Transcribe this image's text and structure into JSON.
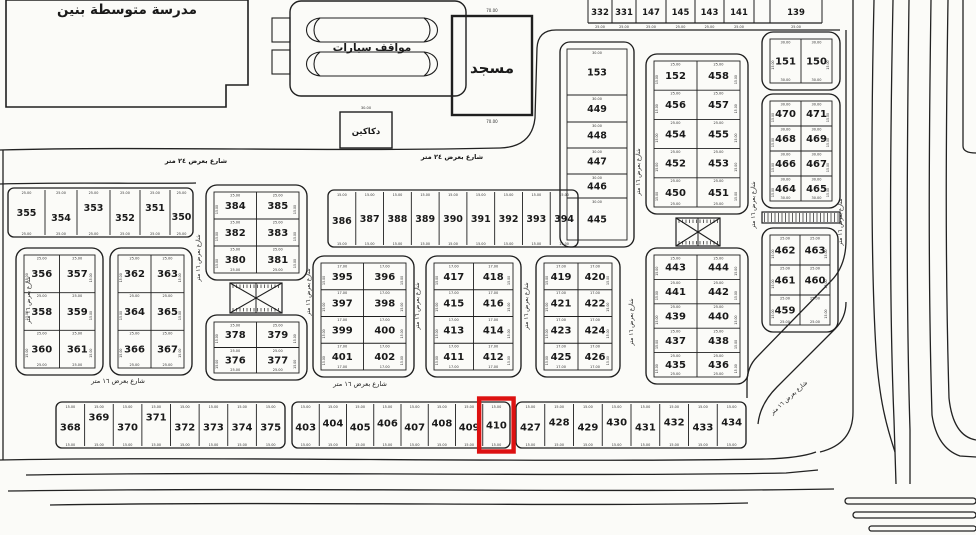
{
  "canvas": {
    "width": 976,
    "height": 535,
    "background": "#fbfbf8",
    "ink": "#1f1f1f",
    "highlight_color": "#dd1111"
  },
  "landmarks": {
    "school": {
      "label": "مدرسة متوسطة بنين"
    },
    "parking": {
      "label": "مواقف سيارات"
    },
    "mosque": {
      "label": "مسجد",
      "dim_top": "70.00",
      "dim_bottom": "70.00"
    },
    "shops": {
      "label": "دكاكين",
      "dim_top": "30.00"
    }
  },
  "streets": {
    "label_16": "شارع بعرض ١٦ متر",
    "label_24": "شارع بعرض ٢٤ متر",
    "placements": [
      {
        "x": 196,
        "y": 163,
        "r": 0,
        "t": "24"
      },
      {
        "x": 452,
        "y": 159,
        "r": 0,
        "t": "24"
      },
      {
        "x": 118,
        "y": 383,
        "r": 0,
        "t": "16"
      },
      {
        "x": 360,
        "y": 386,
        "r": 0,
        "t": "16"
      },
      {
        "x": 790,
        "y": 399,
        "r": -42,
        "t": "16"
      },
      {
        "x": 30,
        "y": 300,
        "r": -90,
        "t": "16"
      },
      {
        "x": 200,
        "y": 258,
        "r": -90,
        "t": "16"
      },
      {
        "x": 310,
        "y": 292,
        "r": -90,
        "t": "16"
      },
      {
        "x": 419,
        "y": 306,
        "r": -90,
        "t": "16"
      },
      {
        "x": 528,
        "y": 306,
        "r": -90,
        "t": "16"
      },
      {
        "x": 640,
        "y": 172,
        "r": -90,
        "t": "16"
      },
      {
        "x": 633,
        "y": 322,
        "r": -90,
        "t": "16"
      },
      {
        "x": 755,
        "y": 205,
        "r": -90,
        "t": "16"
      },
      {
        "x": 842,
        "y": 222,
        "r": -90,
        "t": "16"
      }
    ]
  },
  "dims": {
    "cell": "25.00",
    "strip": "15.00",
    "narrow": "17.00",
    "column": "30.00",
    "side": "15.00"
  },
  "highlight": {
    "plot": "410"
  },
  "top_row": {
    "x": 588,
    "y": 0,
    "h": 23,
    "fs": 8.5,
    "dim": "25.00",
    "cells": [
      "332",
      "331",
      "147",
      "145",
      "143",
      "141",
      "",
      "139"
    ],
    "widths": [
      24,
      24,
      30,
      29,
      29,
      30,
      16,
      52
    ]
  },
  "stack": {
    "x": 560,
    "y": 42,
    "w": 74,
    "h": 205,
    "dim": "30.00",
    "cells": [
      {
        "n": "153",
        "h": 46
      },
      {
        "n": "449",
        "h": 27
      },
      {
        "n": "448",
        "h": 26
      },
      {
        "n": "447",
        "h": 26
      },
      {
        "n": "446",
        "h": 24
      },
      {
        "n": "445",
        "h": 42
      }
    ]
  },
  "blocks": [
    {
      "id": "151-150",
      "x": 762,
      "y": 32,
      "w": 78,
      "h": 58,
      "dim": "30.00",
      "rows": [
        [
          "151",
          "150"
        ]
      ]
    },
    {
      "id": "464-471",
      "x": 762,
      "y": 94,
      "w": 78,
      "h": 114,
      "dim": "30.00",
      "rows": [
        [
          "470",
          "471"
        ],
        [
          "468",
          "469"
        ],
        [
          "466",
          "467"
        ],
        [
          "464",
          "465"
        ]
      ]
    },
    {
      "id": "459-463",
      "x": 762,
      "y": 228,
      "w": 76,
      "h": 104,
      "dim": "25.00",
      "rows": [
        [
          "462",
          "463"
        ],
        [
          "461",
          "460"
        ],
        [
          "459",
          ""
        ]
      ]
    },
    {
      "id": "450-458",
      "x": 646,
      "y": 54,
      "w": 102,
      "h": 160,
      "dim": "25.00",
      "rows": [
        [
          "152",
          "458"
        ],
        [
          "456",
          "457"
        ],
        [
          "454",
          "455"
        ],
        [
          "452",
          "453"
        ],
        [
          "450",
          "451"
        ]
      ]
    },
    {
      "id": "435-444",
      "x": 646,
      "y": 248,
      "w": 102,
      "h": 136,
      "dim": "25.00",
      "rows": [
        [
          "443",
          "444"
        ],
        [
          "441",
          "442"
        ],
        [
          "439",
          "440"
        ],
        [
          "437",
          "438"
        ],
        [
          "435",
          "436"
        ]
      ]
    },
    {
      "id": "380-385",
      "x": 206,
      "y": 185,
      "w": 101,
      "h": 95,
      "dim": "25.00",
      "rows": [
        [
          "384",
          "385"
        ],
        [
          "382",
          "383"
        ],
        [
          "380",
          "381"
        ]
      ]
    },
    {
      "id": "376-379",
      "x": 206,
      "y": 315,
      "w": 101,
      "h": 65,
      "dim": "25.00",
      "rows": [
        [
          "378",
          "379"
        ],
        [
          "376",
          "377"
        ]
      ]
    },
    {
      "id": "356-361",
      "x": 16,
      "y": 248,
      "w": 87,
      "h": 127,
      "dim": "25.00",
      "rows": [
        [
          "356",
          "357"
        ],
        [
          "358",
          "359"
        ],
        [
          "360",
          "361"
        ]
      ]
    },
    {
      "id": "362-367",
      "x": 110,
      "y": 248,
      "w": 82,
      "h": 127,
      "dim": "25.00",
      "rows": [
        [
          "362",
          "363"
        ],
        [
          "364",
          "365"
        ],
        [
          "366",
          "367"
        ]
      ]
    },
    {
      "id": "395-402",
      "x": 313,
      "y": 256,
      "w": 101,
      "h": 121,
      "dim": "17.00",
      "rows": [
        [
          "395",
          "396"
        ],
        [
          "397",
          "398"
        ],
        [
          "399",
          "400"
        ],
        [
          "401",
          "402"
        ]
      ]
    },
    {
      "id": "411-418",
      "x": 426,
      "y": 256,
      "w": 95,
      "h": 121,
      "dim": "17.00",
      "rows": [
        [
          "417",
          "418"
        ],
        [
          "415",
          "416"
        ],
        [
          "413",
          "414"
        ],
        [
          "411",
          "412"
        ]
      ]
    },
    {
      "id": "419-426",
      "x": 536,
      "y": 256,
      "w": 84,
      "h": 121,
      "dim": "17.00",
      "rows": [
        [
          "419",
          "420"
        ],
        [
          "421",
          "422"
        ],
        [
          "423",
          "424"
        ],
        [
          "425",
          "426"
        ]
      ]
    }
  ],
  "strips": [
    {
      "id": "row-350-355",
      "x": 8,
      "y": 188,
      "w": 185,
      "h": 49,
      "fs": 9.5,
      "dim": "25.00",
      "cells": [
        "355",
        "354",
        "353",
        "352",
        "351",
        "350"
      ],
      "widths": [
        37,
        32,
        33,
        30,
        30,
        23
      ],
      "offsets": [
        0,
        5,
        -5,
        5,
        -5,
        4
      ]
    },
    {
      "id": "row-386-394",
      "x": 328,
      "y": 190,
      "w": 250,
      "h": 57,
      "fs": 9.5,
      "dim": "15.00",
      "cells": [
        "386",
        "387",
        "388",
        "389",
        "390",
        "391",
        "392",
        "393",
        "394"
      ],
      "offsets": [
        2,
        0,
        0,
        0,
        0,
        0,
        0,
        0,
        0
      ]
    },
    {
      "id": "row-368-375",
      "x": 56,
      "y": 402,
      "w": 229,
      "h": 46,
      "fs": 10,
      "dim": "15.00",
      "cells": [
        "368",
        "369",
        "370",
        "371",
        "372",
        "373",
        "374",
        "375"
      ],
      "offsets": [
        2,
        -8,
        2,
        -8,
        2,
        2,
        2,
        2
      ]
    },
    {
      "id": "row-403-410",
      "x": 292,
      "y": 402,
      "w": 218,
      "h": 46,
      "fs": 10,
      "dim": "15.00",
      "cells": [
        "403",
        "404",
        "405",
        "406",
        "407",
        "408",
        "409",
        "410"
      ],
      "offsets": [
        2,
        -2,
        2,
        -2,
        2,
        -2,
        2,
        0
      ]
    },
    {
      "id": "row-427-434",
      "x": 516,
      "y": 402,
      "w": 230,
      "h": 46,
      "fs": 10,
      "dim": "15.00",
      "cells": [
        "427",
        "428",
        "429",
        "430",
        "431",
        "432",
        "433",
        "434"
      ],
      "offsets": [
        2,
        -3,
        2,
        -3,
        2,
        -3,
        2,
        -3
      ]
    }
  ],
  "hatches": [
    {
      "x": 230,
      "y": 283,
      "w": 52,
      "h": 30,
      "type": "x"
    },
    {
      "x": 676,
      "y": 218,
      "w": 44,
      "h": 28,
      "type": "x"
    },
    {
      "x": 762,
      "y": 212,
      "w": 78,
      "h": 11,
      "type": "bar"
    }
  ]
}
